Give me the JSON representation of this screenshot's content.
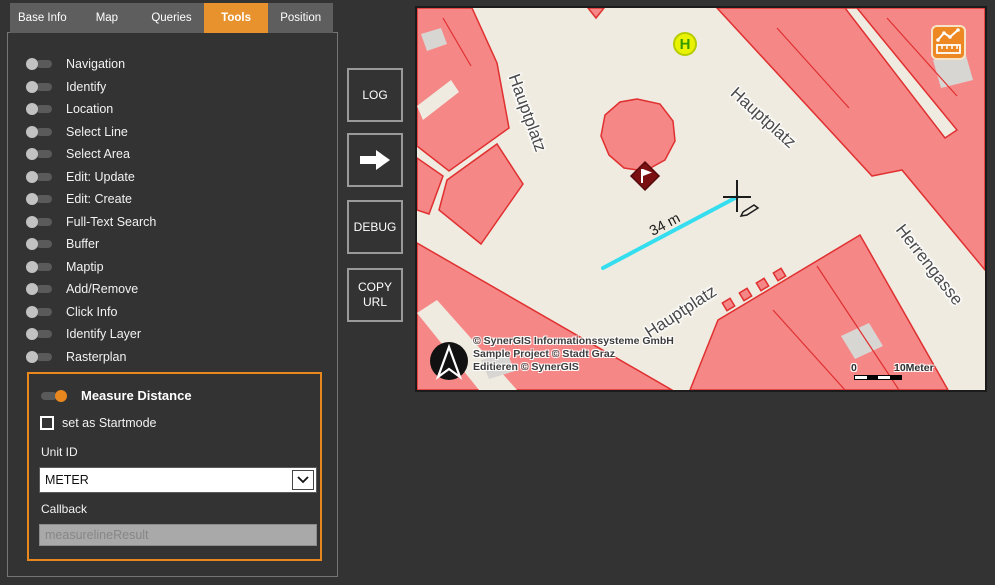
{
  "tabs": [
    {
      "label": "Base Info",
      "active": false
    },
    {
      "label": "Map",
      "active": false
    },
    {
      "label": "Queries",
      "active": false
    },
    {
      "label": "Tools",
      "active": true
    },
    {
      "label": "Position",
      "active": false
    }
  ],
  "tools": {
    "items": [
      "Navigation",
      "Identify",
      "Location",
      "Select Line",
      "Select Area",
      "Edit: Update",
      "Edit: Create",
      "Full-Text Search",
      "Buffer",
      "Maptip",
      "Add/Remove",
      "Click Info",
      "Identify Layer",
      "Rasterplan"
    ]
  },
  "measure_panel": {
    "title": "Measure Distance",
    "toggle_state": "on",
    "startmode_label": "set as Startmode",
    "startmode_checked": false,
    "unit_label": "Unit ID",
    "unit_value": "METER",
    "callback_label": "Callback",
    "callback_placeholder": "measurelineResult"
  },
  "action_buttons": {
    "log": "LOG",
    "forward_icon": "right-arrow",
    "debug": "DEBUG",
    "copy_url": "COPY URL"
  },
  "map": {
    "street_labels": {
      "left": "Hauptplatz",
      "top_right": "Hauptplatz",
      "bottom": "Hauptplatz",
      "right": "Herrengasse"
    },
    "measurement_label": "34 m",
    "bus_stop_letter": "H",
    "attribution_lines": [
      "© SynerGIS Informationssysteme GmbH",
      "Sample Project © Stadt Graz",
      "Editieren © SynerGIS"
    ],
    "scale": {
      "start": "0",
      "end": "10Meter"
    },
    "colors": {
      "background": "#efebe0",
      "building_fill": "#f58787",
      "building_stroke": "#e03030",
      "gray_patch": "#d8d6d3",
      "measure_line": "#35deef",
      "marker_fill": "#7a1012",
      "bus_stop_fill": "#e9f200",
      "bus_stop_text": "#379b00",
      "accent_orange": "#e8922d"
    }
  }
}
